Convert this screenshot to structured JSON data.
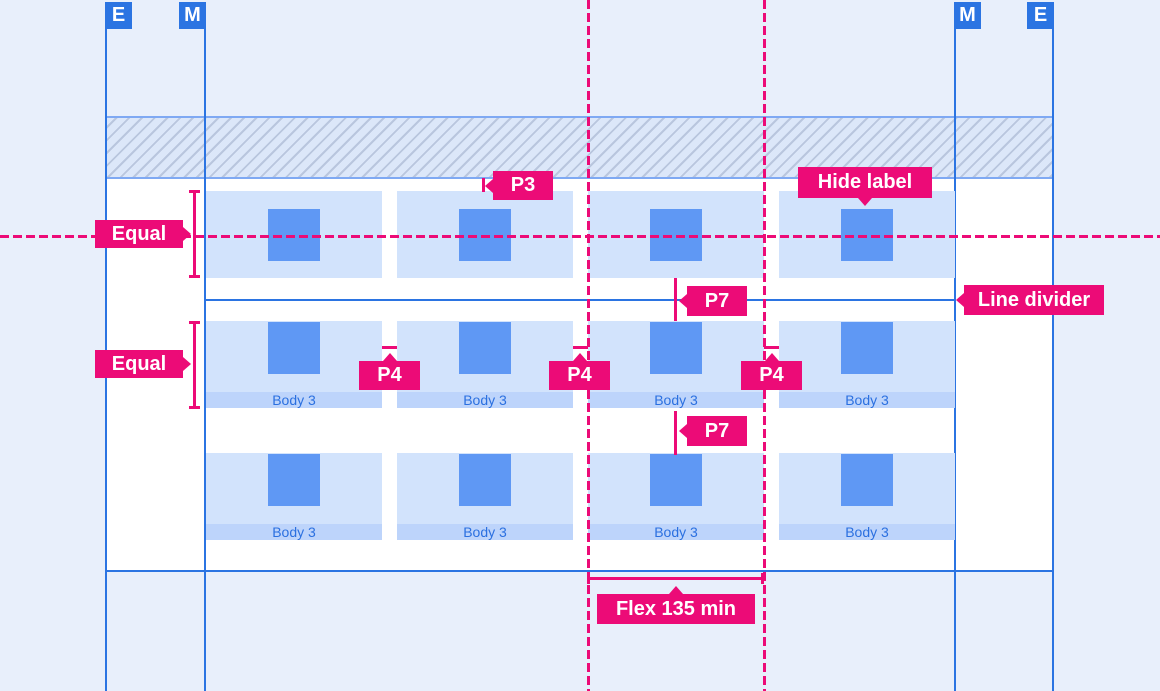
{
  "markers": {
    "edge": "E",
    "margin": "M"
  },
  "annotations": {
    "p3": "P3",
    "p4": "P4",
    "p7": "P7",
    "equal": "Equal",
    "hide_label": "Hide label",
    "line_divider": "Line divider",
    "flex_min": "Flex 135 min"
  },
  "cards": {
    "label": "Body 3",
    "rows": 3,
    "columns": 4,
    "labeled_rows": [
      2,
      3
    ]
  },
  "colors": {
    "annotation_pink": "#EC0B77",
    "grid_blue": "#2B74E2",
    "hatch_border_blue": "#7FA9F3",
    "hatch_fill": "#DCE7F9",
    "hatch_line": "#B9C6DE",
    "card_fill": "#D2E3FC",
    "icon_fill": "#5F98F4",
    "card_label_strip": "#BDD4FB",
    "card_label_text": "#2B70E0",
    "page_background": "#E8EFFB",
    "canvas_background": "#FFFFFF"
  }
}
